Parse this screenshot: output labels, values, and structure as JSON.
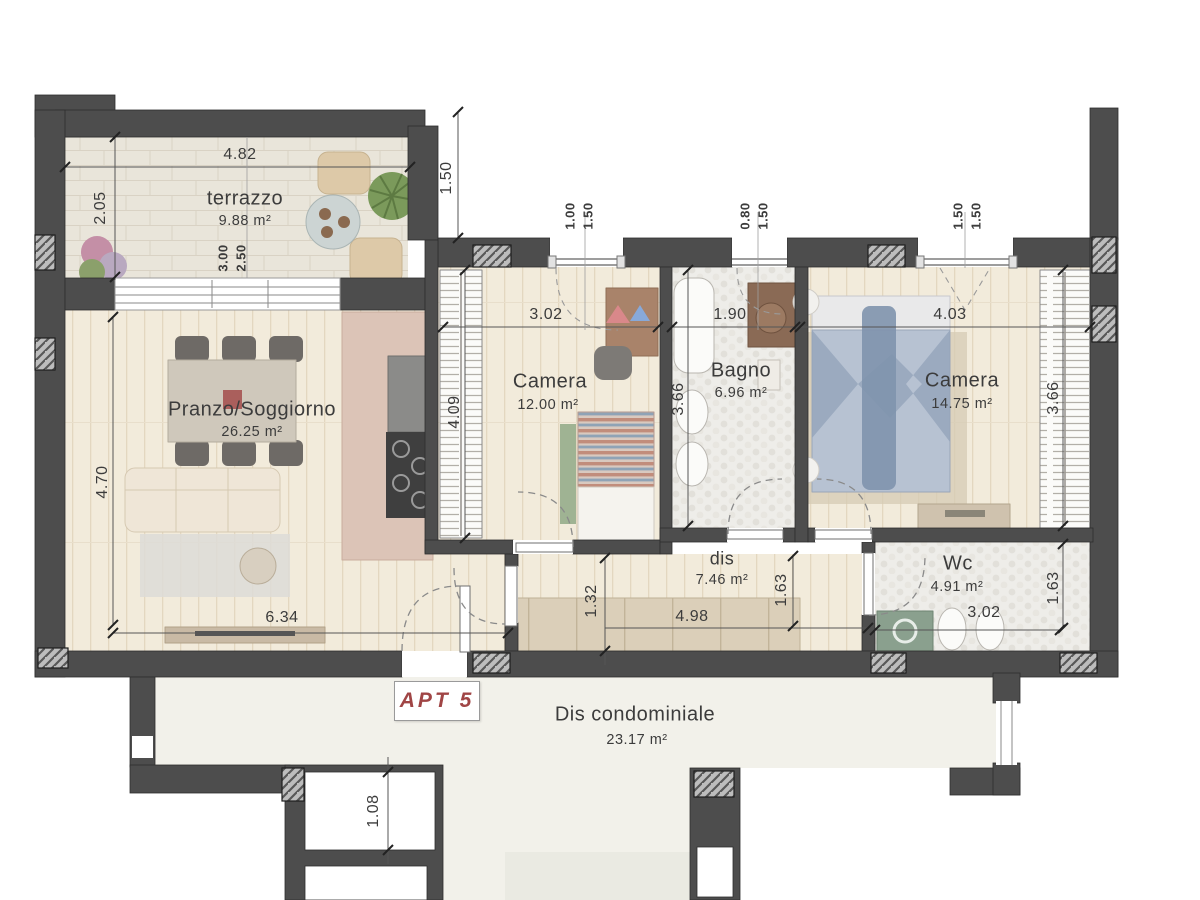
{
  "title": {
    "apartment": "APT 5"
  },
  "rooms": {
    "terrazzo": {
      "name": "terrazzo",
      "area": "9.88 m²"
    },
    "living": {
      "name": "Pranzo/Soggiorno",
      "area": "26.25 m²"
    },
    "camera1": {
      "name": "Camera",
      "area": "12.00 m²"
    },
    "bagno": {
      "name": "Bagno",
      "area": "6.96 m²"
    },
    "camera2": {
      "name": "Camera",
      "area": "14.75 m²"
    },
    "dis": {
      "name": "dis",
      "area": "7.46 m²"
    },
    "wc": {
      "name": "Wc",
      "area": "4.91 m²"
    },
    "condo": {
      "name": "Dis condominiale",
      "area": "23.17 m²"
    }
  },
  "dims": {
    "terrazzo_width": "4.82",
    "terrazzo_depth": "2.05",
    "terrace_door_w": "3.00",
    "terrace_door_h": "2.50",
    "side_setback": "1.50",
    "win1_w": "1.00",
    "win1_h": "1.50",
    "win2_w": "0.80",
    "win2_h": "1.50",
    "win3_w": "1.50",
    "win3_h": "1.50",
    "living_d": "4.70",
    "living_w": "6.34",
    "cam1_w": "3.02",
    "cam1_d": "4.09",
    "bagno_w": "1.90",
    "bagno_d": "3.66",
    "cam2_w": "4.03",
    "cam2_d": "3.66",
    "dis_d": "1.32",
    "dis_w": "4.98",
    "dis_e": "1.63",
    "wc_w": "3.02",
    "wc_e": "1.63",
    "stair_w": "1.08"
  },
  "colors": {
    "wall": "#4d4d4d",
    "apt_label": "#a04545",
    "dim_text": "#3c3c3c"
  }
}
